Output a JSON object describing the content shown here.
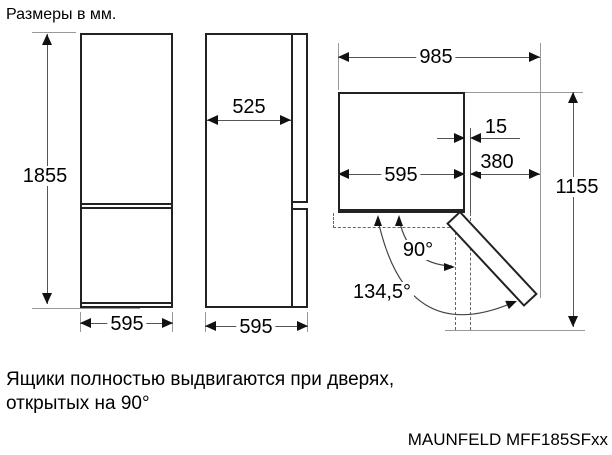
{
  "title": "Размеры в мм.",
  "views": {
    "front": {
      "height": "1855",
      "width": "595"
    },
    "side": {
      "depth": "525",
      "total_depth": "595"
    },
    "top": {
      "total_width": "985",
      "hinge_offset": "15",
      "body_width": "595",
      "door_clearance": "380",
      "depth_door_open": "1155",
      "drawer_angle": "90°",
      "max_door_angle": "134,5°"
    }
  },
  "note": {
    "line1": "Ящики полностью выдвигаются при дверях,",
    "line2": "открытых на 90°"
  },
  "model": "MAUNFELD MFF185SFxx",
  "colors": {
    "outline": "#222222",
    "dimension_line": "#555555",
    "extension_line": "#999999",
    "text": "#000000",
    "background": "#ffffff"
  }
}
